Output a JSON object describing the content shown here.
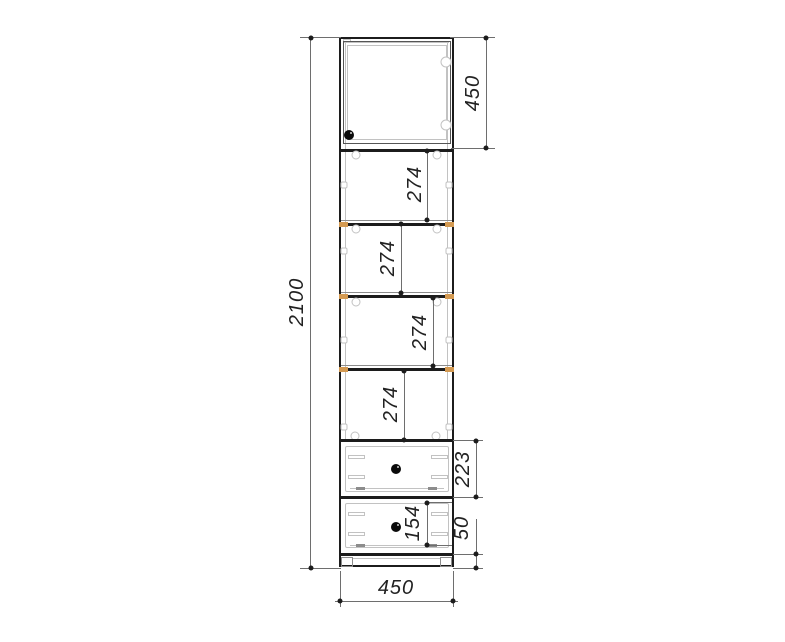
{
  "colors": {
    "bg": "#ffffff",
    "line": "#1c1c1c",
    "dim": "#6e6e6e",
    "text": "#222222",
    "detail": "#c2c2c2",
    "detail-dark": "#8c8c8c",
    "shelf-edge": "#d49a52",
    "knob": "#0a0a0a"
  },
  "dimensions": {
    "overall_height": "2100",
    "overall_width": "450",
    "door_height": "450",
    "compartments": [
      "274",
      "274",
      "274",
      "274"
    ],
    "drawer_front_height": "223",
    "drawer_box_height": "154",
    "plinth_height": "50"
  }
}
